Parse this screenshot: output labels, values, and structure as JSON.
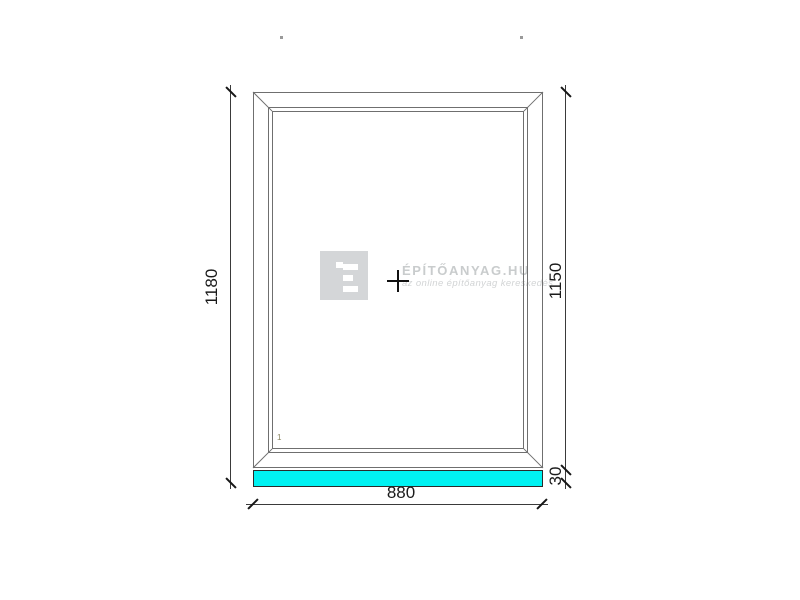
{
  "drawing": {
    "type": "window-technical-drawing",
    "dimensions": {
      "left_total_height_mm": "1180",
      "right_frame_height_mm": "1150",
      "sill_height_mm": "30",
      "width_mm": "880"
    },
    "sash_label": "1",
    "colors": {
      "sill_fill": "#00F2F2",
      "frame_line": "#6f6f6f",
      "dimension_line": "#3a3a3a",
      "dimension_text": "#1a1a1a"
    }
  },
  "watermark": {
    "logo_letter": "É",
    "brand": "ÉPÍTŐANYAG.HU",
    "tagline": "az online építőanyag kereskedés",
    "logo_square_color": "#d4d6d8"
  }
}
